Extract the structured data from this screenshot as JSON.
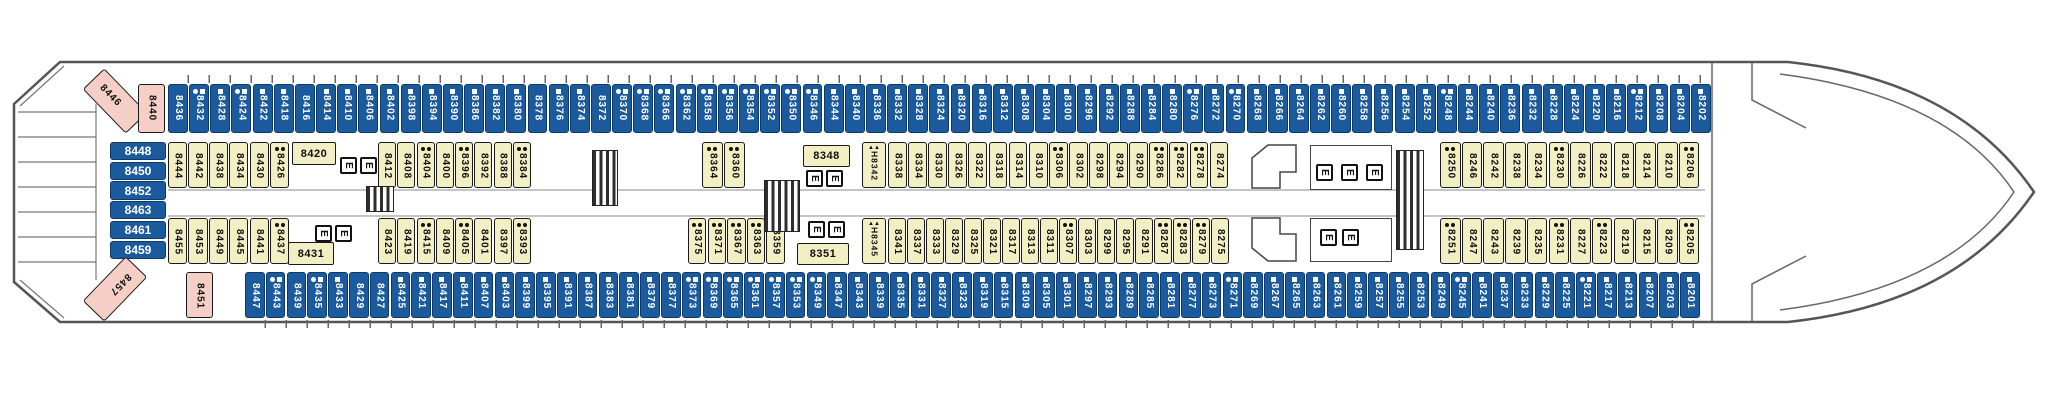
{
  "deck": {
    "title": "Deck 8 cabin plan",
    "colors": {
      "blue_cabin": "#1b5b9d",
      "yellow_cabin": "#f3efc5",
      "pink_cabin": "#f5cfc6",
      "hull_line": "#555555"
    },
    "legend": {
      "elevator": "E",
      "stairs": "stairs",
      "triangles": "▲▲"
    },
    "leftStack": [
      {
        "n": "8448"
      },
      {
        "n": "8450"
      },
      {
        "n": "8452"
      },
      {
        "n": "8463"
      },
      {
        "n": "8461"
      },
      {
        "n": "8459"
      }
    ],
    "pink": {
      "p8446": "8446",
      "p8440": "8440",
      "p8457": "8457",
      "p8451": "8451"
    },
    "horizontal": {
      "c8420": "8420",
      "c8431": "8431",
      "c8348": "8348",
      "c8351": "8351"
    },
    "hcabins": {
      "h8342": "H8342",
      "h8345": "H8345"
    },
    "rows": {
      "top": [
        {
          "n": "8436",
          "m": ""
        },
        {
          "n": "8432",
          "m": "cs"
        },
        {
          "n": "8428",
          "m": "s"
        },
        {
          "n": "8424",
          "m": "cs"
        },
        {
          "n": "8422",
          "m": "s"
        },
        {
          "n": "8418",
          "m": "s"
        },
        {
          "n": "8416",
          "m": ""
        },
        {
          "n": "8414",
          "m": "s"
        },
        {
          "n": "8410",
          "m": "s"
        },
        {
          "n": "8406",
          "m": "s"
        },
        {
          "n": "8402",
          "m": "s"
        },
        {
          "n": "8398",
          "m": "s"
        },
        {
          "n": "8394",
          "m": "s"
        },
        {
          "n": "8390",
          "m": "s"
        },
        {
          "n": "8386",
          "m": "s"
        },
        {
          "n": "8382",
          "m": "s"
        },
        {
          "n": "8380",
          "m": "s"
        },
        {
          "n": "8378",
          "m": ""
        },
        {
          "n": "8376",
          "m": "s"
        },
        {
          "n": "8374",
          "m": "s"
        },
        {
          "n": "8372",
          "m": ""
        },
        {
          "n": "8370",
          "m": "cs"
        },
        {
          "n": "8368",
          "m": "cs"
        },
        {
          "n": "8366",
          "m": "cs"
        },
        {
          "n": "8362",
          "m": "cs"
        },
        {
          "n": "8358",
          "m": "cs"
        },
        {
          "n": "8356",
          "m": "cs"
        },
        {
          "n": "8354",
          "m": "cs"
        },
        {
          "n": "8352",
          "m": "cs"
        },
        {
          "n": "8350",
          "m": "cs"
        },
        {
          "n": "8346",
          "m": "cs"
        },
        {
          "n": "8344",
          "m": "s"
        },
        {
          "n": "8340",
          "m": "s"
        },
        {
          "n": "8336",
          "m": "s"
        },
        {
          "n": "8332",
          "m": "s"
        },
        {
          "n": "8328",
          "m": "s"
        },
        {
          "n": "8324",
          "m": "s"
        },
        {
          "n": "8320",
          "m": "s"
        },
        {
          "n": "8316",
          "m": "s"
        },
        {
          "n": "8312",
          "m": "s"
        },
        {
          "n": "8308",
          "m": "s"
        },
        {
          "n": "8304",
          "m": "s"
        },
        {
          "n": "8300",
          "m": "s"
        },
        {
          "n": "8296",
          "m": "s"
        },
        {
          "n": "8292",
          "m": "s"
        },
        {
          "n": "8288",
          "m": "s"
        },
        {
          "n": "8284",
          "m": "s"
        },
        {
          "n": "8280",
          "m": "s"
        },
        {
          "n": "8276",
          "m": "cs"
        },
        {
          "n": "8272",
          "m": "s"
        },
        {
          "n": "8270",
          "m": "cs"
        },
        {
          "n": "8268",
          "m": "s"
        },
        {
          "n": "8266",
          "m": "s"
        },
        {
          "n": "8264",
          "m": "s"
        },
        {
          "n": "8262",
          "m": "s"
        },
        {
          "n": "8260",
          "m": "s"
        },
        {
          "n": "8258",
          "m": "s"
        },
        {
          "n": "8256",
          "m": "s"
        },
        {
          "n": "8254",
          "m": "s"
        },
        {
          "n": "8252",
          "m": "s"
        },
        {
          "n": "8248",
          "m": "cs"
        },
        {
          "n": "8244",
          "m": "s"
        },
        {
          "n": "8240",
          "m": "s"
        },
        {
          "n": "8236",
          "m": "s"
        },
        {
          "n": "8232",
          "m": "s"
        },
        {
          "n": "8228",
          "m": "s"
        },
        {
          "n": "8224",
          "m": "s"
        },
        {
          "n": "8220",
          "m": "s"
        },
        {
          "n": "8216",
          "m": "s"
        },
        {
          "n": "8212",
          "m": "cs"
        },
        {
          "n": "8208",
          "m": "s"
        },
        {
          "n": "8204",
          "m": "s"
        },
        {
          "n": "8202",
          "m": "s"
        }
      ],
      "row2left": [
        {
          "n": "8444",
          "m": ""
        },
        {
          "n": "8442",
          "m": ""
        },
        {
          "n": "8438",
          "m": ""
        },
        {
          "n": "8434",
          "m": ""
        },
        {
          "n": "8430",
          "m": ""
        },
        {
          "n": "8426",
          "m": "dd"
        }
      ],
      "row2mid1": [
        {
          "n": "8412",
          "m": ""
        },
        {
          "n": "8408",
          "m": ""
        },
        {
          "n": "8404",
          "m": "dd"
        },
        {
          "n": "8400",
          "m": ""
        },
        {
          "n": "8396",
          "m": "dd"
        },
        {
          "n": "8392",
          "m": ""
        },
        {
          "n": "8388",
          "m": ""
        },
        {
          "n": "8384",
          "m": "dd"
        }
      ],
      "row2mid2": [
        {
          "n": "8364",
          "m": "dd"
        },
        {
          "n": "8360",
          "m": "dd"
        }
      ],
      "row2mid3": [
        {
          "n": "8338",
          "m": ""
        },
        {
          "n": "8334",
          "m": ""
        },
        {
          "n": "8330",
          "m": ""
        },
        {
          "n": "8326",
          "m": ""
        },
        {
          "n": "8322",
          "m": ""
        },
        {
          "n": "8318",
          "m": ""
        },
        {
          "n": "8314",
          "m": ""
        },
        {
          "n": "8310",
          "m": ""
        },
        {
          "n": "8306",
          "m": "dd"
        },
        {
          "n": "8302",
          "m": ""
        },
        {
          "n": "8298",
          "m": ""
        },
        {
          "n": "8294",
          "m": ""
        },
        {
          "n": "8290",
          "m": ""
        },
        {
          "n": "8286",
          "m": "dd"
        },
        {
          "n": "8282",
          "m": "dd"
        },
        {
          "n": "8278",
          "m": "dd"
        },
        {
          "n": "8274",
          "m": ""
        }
      ],
      "row2right": [
        {
          "n": "8250",
          "m": "dd"
        },
        {
          "n": "8246",
          "m": ""
        },
        {
          "n": "8242",
          "m": ""
        },
        {
          "n": "8238",
          "m": ""
        },
        {
          "n": "8234",
          "m": ""
        },
        {
          "n": "8230",
          "m": "dd"
        },
        {
          "n": "8226",
          "m": ""
        },
        {
          "n": "8222",
          "m": ""
        },
        {
          "n": "8218",
          "m": ""
        },
        {
          "n": "8214",
          "m": ""
        },
        {
          "n": "8210",
          "m": ""
        },
        {
          "n": "8206",
          "m": "dd"
        }
      ],
      "row3left": [
        {
          "n": "8455",
          "m": ""
        },
        {
          "n": "8453",
          "m": ""
        },
        {
          "n": "8449",
          "m": ""
        },
        {
          "n": "8445",
          "m": ""
        },
        {
          "n": "8441",
          "m": ""
        },
        {
          "n": "8437",
          "m": "dd"
        }
      ],
      "row3mid1": [
        {
          "n": "8423",
          "m": ""
        },
        {
          "n": "8419",
          "m": ""
        },
        {
          "n": "8415",
          "m": "dd"
        },
        {
          "n": "8409",
          "m": ""
        },
        {
          "n": "8405",
          "m": "dd"
        },
        {
          "n": "8401",
          "m": ""
        },
        {
          "n": "8397",
          "m": ""
        },
        {
          "n": "8393",
          "m": "dd"
        }
      ],
      "row3mid2": [
        {
          "n": "8375",
          "m": "dd"
        },
        {
          "n": "8371",
          "m": "dd"
        },
        {
          "n": "8367",
          "m": "dd"
        },
        {
          "n": "8363",
          "m": "dd"
        },
        {
          "n": "8359",
          "m": ""
        }
      ],
      "row3mid3": [
        {
          "n": "8341",
          "m": ""
        },
        {
          "n": "8337",
          "m": ""
        },
        {
          "n": "8333",
          "m": ""
        },
        {
          "n": "8329",
          "m": ""
        },
        {
          "n": "8325",
          "m": ""
        },
        {
          "n": "8321",
          "m": ""
        },
        {
          "n": "8317",
          "m": ""
        },
        {
          "n": "8313",
          "m": ""
        },
        {
          "n": "8311",
          "m": ""
        },
        {
          "n": "8307",
          "m": "dd"
        },
        {
          "n": "8303",
          "m": ""
        },
        {
          "n": "8299",
          "m": ""
        },
        {
          "n": "8295",
          "m": ""
        },
        {
          "n": "8291",
          "m": ""
        },
        {
          "n": "8287",
          "m": "dd"
        },
        {
          "n": "8283",
          "m": "dd"
        },
        {
          "n": "8279",
          "m": "dd"
        },
        {
          "n": "8275",
          "m": ""
        }
      ],
      "row3right": [
        {
          "n": "8251",
          "m": "dd"
        },
        {
          "n": "8247",
          "m": ""
        },
        {
          "n": "8243",
          "m": ""
        },
        {
          "n": "8239",
          "m": ""
        },
        {
          "n": "8235",
          "m": ""
        },
        {
          "n": "8231",
          "m": "dd"
        },
        {
          "n": "8227",
          "m": ""
        },
        {
          "n": "8223",
          "m": "dd"
        },
        {
          "n": "8219",
          "m": ""
        },
        {
          "n": "8215",
          "m": ""
        },
        {
          "n": "8209",
          "m": ""
        },
        {
          "n": "8205",
          "m": "dd"
        }
      ],
      "bottom": [
        {
          "n": "8447",
          "m": ""
        },
        {
          "n": "8443",
          "m": "cs"
        },
        {
          "n": "8439",
          "m": ""
        },
        {
          "n": "8435",
          "m": "cs"
        },
        {
          "n": "8433",
          "m": "s"
        },
        {
          "n": "8429",
          "m": ""
        },
        {
          "n": "8427",
          "m": ""
        },
        {
          "n": "8425",
          "m": "s"
        },
        {
          "n": "8421",
          "m": "s"
        },
        {
          "n": "8417",
          "m": "s"
        },
        {
          "n": "8411",
          "m": "s"
        },
        {
          "n": "8407",
          "m": "s"
        },
        {
          "n": "8403",
          "m": "s"
        },
        {
          "n": "8399",
          "m": "s"
        },
        {
          "n": "8395",
          "m": "s"
        },
        {
          "n": "8391",
          "m": "s"
        },
        {
          "n": "8387",
          "m": "s"
        },
        {
          "n": "8383",
          "m": "s"
        },
        {
          "n": "8381",
          "m": "s"
        },
        {
          "n": "8379",
          "m": "s"
        },
        {
          "n": "8377",
          "m": "s"
        },
        {
          "n": "8373",
          "m": "cs"
        },
        {
          "n": "8369",
          "m": "cs"
        },
        {
          "n": "8365",
          "m": "cs"
        },
        {
          "n": "8361",
          "m": "cs"
        },
        {
          "n": "8357",
          "m": "cs"
        },
        {
          "n": "8353",
          "m": "cs"
        },
        {
          "n": "8349",
          "m": "cs"
        },
        {
          "n": "8347",
          "m": "s"
        },
        {
          "n": "8343",
          "m": "s"
        },
        {
          "n": "8339",
          "m": "s"
        },
        {
          "n": "8335",
          "m": "s"
        },
        {
          "n": "8331",
          "m": "s"
        },
        {
          "n": "8327",
          "m": "s"
        },
        {
          "n": "8323",
          "m": "s"
        },
        {
          "n": "8319",
          "m": "s"
        },
        {
          "n": "8315",
          "m": "s"
        },
        {
          "n": "8309",
          "m": "s"
        },
        {
          "n": "8305",
          "m": "s"
        },
        {
          "n": "8301",
          "m": "s"
        },
        {
          "n": "8297",
          "m": "s"
        },
        {
          "n": "8293",
          "m": "s"
        },
        {
          "n": "8289",
          "m": "s"
        },
        {
          "n": "8285",
          "m": "s"
        },
        {
          "n": "8281",
          "m": "s"
        },
        {
          "n": "8277",
          "m": "s"
        },
        {
          "n": "8273",
          "m": "s"
        },
        {
          "n": "8271",
          "m": "cs"
        },
        {
          "n": "8269",
          "m": "s"
        },
        {
          "n": "8267",
          "m": "s"
        },
        {
          "n": "8265",
          "m": "s"
        },
        {
          "n": "8263",
          "m": "s"
        },
        {
          "n": "8261",
          "m": "s"
        },
        {
          "n": "8259",
          "m": "s"
        },
        {
          "n": "8257",
          "m": "s"
        },
        {
          "n": "8255",
          "m": "s"
        },
        {
          "n": "8253",
          "m": "s"
        },
        {
          "n": "8249",
          "m": "s"
        },
        {
          "n": "8245",
          "m": "cs"
        },
        {
          "n": "8241",
          "m": "s"
        },
        {
          "n": "8237",
          "m": "s"
        },
        {
          "n": "8233",
          "m": "s"
        },
        {
          "n": "8229",
          "m": "s"
        },
        {
          "n": "8225",
          "m": "s"
        },
        {
          "n": "8221",
          "m": "cs"
        },
        {
          "n": "8217",
          "m": "s"
        },
        {
          "n": "8213",
          "m": "s"
        },
        {
          "n": "8207",
          "m": "s"
        },
        {
          "n": "8203",
          "m": "s"
        },
        {
          "n": "8201",
          "m": "s"
        }
      ]
    }
  }
}
